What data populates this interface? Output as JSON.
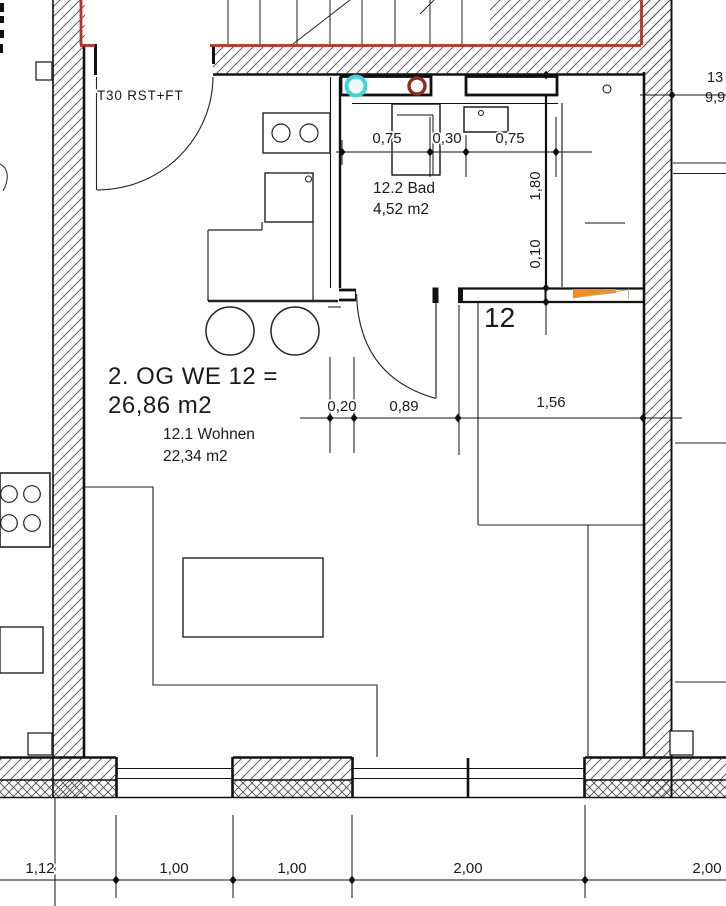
{
  "plan": {
    "title_line1": "2. OG WE 12 =",
    "title_line2": "26,86 m2",
    "living_label": "12.1 Wohnen",
    "living_area": "22,34 m2",
    "bath_label": "12.2 Bad",
    "bath_area": "4,52 m2",
    "hall_number": "12",
    "entry_door_label": "T30 RST+FT",
    "dims": {
      "bath_top": [
        "0,75",
        "0,30",
        "0,75"
      ],
      "bath_side_vertical": [
        "1,80",
        "0,10"
      ],
      "hall_chain": [
        "0,20",
        "0,89",
        "1,56"
      ],
      "bottom_chain": [
        "1,12",
        "1,00",
        "1,00",
        "2,00",
        "2,00"
      ],
      "right_edge_clipped": [
        "13",
        "9,9"
      ]
    },
    "colors": {
      "stair_outline_red": "#b33327",
      "pipe_cyan": "#3fd4da",
      "pipe_red": "#8f2b21",
      "marker_orange": "#ef8e1e"
    }
  }
}
